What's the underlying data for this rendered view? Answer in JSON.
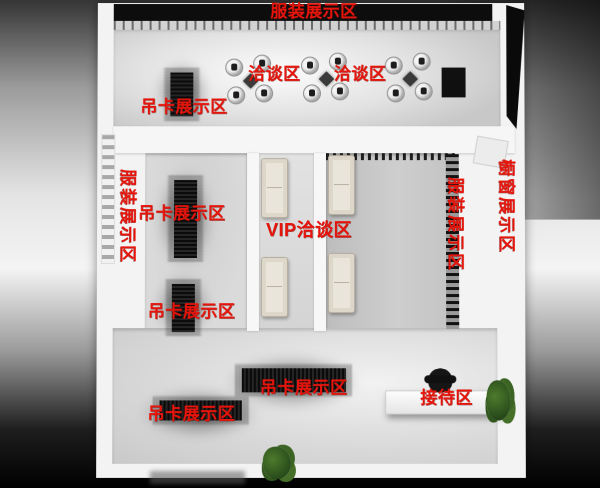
{
  "scene": {
    "type": "store-floorplan-render",
    "label_color": "#e6150c",
    "wall_color": "#f3f3f3",
    "top_bar_color": "#0d0d0d"
  },
  "zones": {
    "top_display": "服装展示区",
    "negotiation_left": "洽谈区",
    "negotiation_right": "洽谈区",
    "hangtag_top": "吊卡展示区",
    "clothing_left_wall": "服装展示区",
    "hangtag_mid_upper": "吊卡展示区",
    "hangtag_mid_lower": "吊卡展示区",
    "vip": "VIP洽谈区",
    "clothing_right_inner": "服装展示区",
    "window_display": "橱窗展示区",
    "hangtag_bottom_left": "吊卡展示区",
    "hangtag_bottom_center": "吊卡展示区",
    "reception": "接待区"
  }
}
